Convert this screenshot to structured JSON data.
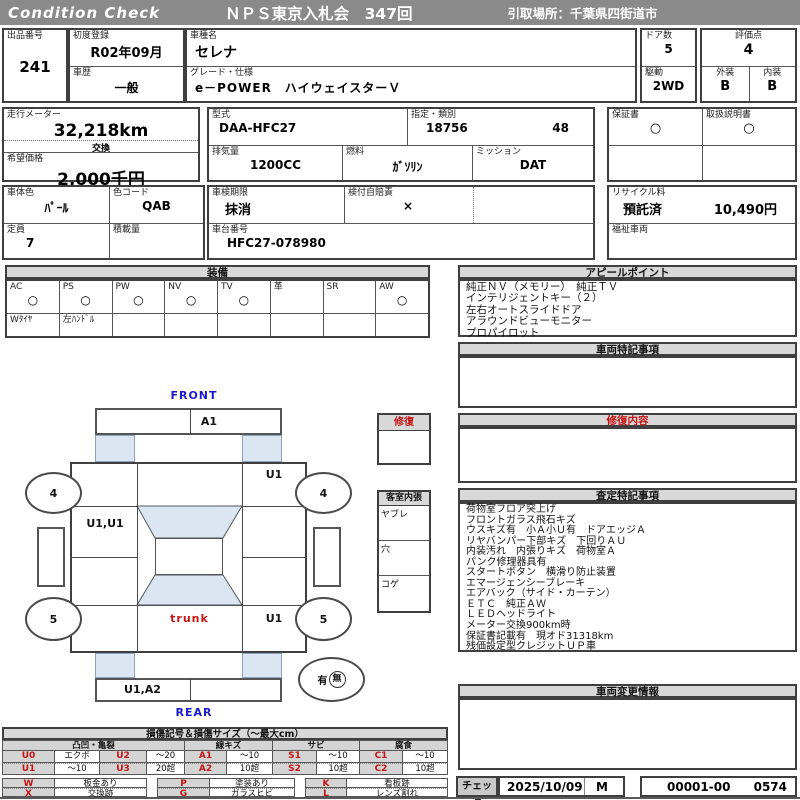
{
  "header": {
    "brand": "Condition  Check",
    "title": "ＮＰＳ東京入札会　347回",
    "pickup": "引取場所：千葉県四街道市"
  },
  "info": {
    "lot_label": "出品番号",
    "lot_value": "241",
    "first_reg_label": "初度登録",
    "first_reg_value": "R02年09月",
    "history_label": "車歴",
    "history_value": "一般",
    "model_name_label": "車種名",
    "model_name_value": "セレナ",
    "grade_label": "グレード・仕様",
    "grade_value": "e－POWER　ハイウェイスターＶ",
    "doors_label": "ドア数",
    "doors_value": "5",
    "score_label": "評価点",
    "score_value": "4",
    "drive_label": "駆動",
    "drive_value": "2WD",
    "exterior_label": "外装",
    "exterior_value": "B",
    "interior_label": "内装",
    "interior_value": "B",
    "odometer_label": "走行メーター",
    "odometer_value": "32,218km",
    "odometer_note": "交換",
    "price_label": "希望価格",
    "price_value": "2,000千円",
    "model_code_label": "型式",
    "model_code_value": "DAA-HFC27",
    "class_label": "指定・類別",
    "class_value1": "18756",
    "class_value2": "48",
    "displacement_label": "排気量",
    "displacement_value": "1200CC",
    "fuel_label": "燃料",
    "fuel_value": "ｶﾞｿﾘﾝ",
    "mission_label": "ミッション",
    "mission_value": "DAT",
    "warranty_label": "保証書",
    "warranty_value": "○",
    "manual_label": "取扱説明書",
    "manual_value": "○",
    "body_color_label": "車体色",
    "body_color_value": "ﾊﾟｰﾙ",
    "color_code_label": "色コード",
    "color_code_value": "QAB",
    "inspection_label": "車検期限",
    "inspection_value": "抹消",
    "insurance_label": "検付自賠責",
    "insurance_value": "×",
    "capacity_label": "定員",
    "capacity_value": "7",
    "load_label": "積載量",
    "load_value": "",
    "chassis_label": "車台番号",
    "chassis_value": "HFC27-078980",
    "recycle_label": "リサイクル料",
    "recycle_status": "預託済",
    "recycle_value": "10,490円",
    "welfare_label": "福祉車両",
    "welfare_value": ""
  },
  "equipment": {
    "title": "装備",
    "items": [
      {
        "label": "AC",
        "mark": "○"
      },
      {
        "label": "PS",
        "mark": "○"
      },
      {
        "label": "PW",
        "mark": "○"
      },
      {
        "label": "NV",
        "mark": "○"
      },
      {
        "label": "TV",
        "mark": "○"
      },
      {
        "label": "革",
        "mark": ""
      },
      {
        "label": "SR",
        "mark": ""
      },
      {
        "label": "AW",
        "mark": "○"
      }
    ],
    "extras": [
      "Wﾀｲﾔ",
      "左ﾊﾝﾄﾞﾙ",
      "",
      "",
      "",
      "",
      "",
      ""
    ]
  },
  "appeal": {
    "title": "アピールポイント",
    "lines": [
      "純正ＮＶ（メモリー）　純正ＴＶ",
      "インテリジェントキー（２）",
      "左右オートスライドドア",
      "アラウンドビューモニター",
      "プロパイロット"
    ]
  },
  "vehicle_notes": {
    "title": "車両特記事項"
  },
  "repair_detail": {
    "title": "修復内容"
  },
  "assessment": {
    "title": "査定特記事項",
    "lines": [
      "荷物室フロア突上げ",
      "フロントガラス飛石キズ",
      "ウスキズ有　小Ａ小Ｕ有　ドアエッジＡ",
      "リヤバンパー下部キズ　下回りＡＵ",
      "内装汚れ　内張りキズ　荷物室Ａ",
      "パンク修理器具有",
      "スタートボタン　横滑り防止装置",
      "エマージェンシーブレーキ",
      "エアバック（サイド・カーテン）",
      "ＥＴＣ　純正ＡＷ",
      "ＬＥＤヘッドライト",
      "メーター交換900km時",
      "保証書記載有　現オド31318km",
      "残価設定型クレジットＵＰ車"
    ]
  },
  "change_info": {
    "title": "車両変更情報"
  },
  "check": {
    "label": "チェック",
    "date": "2025/10/09",
    "inspector": "M",
    "number1": "00001-00",
    "number2": "0574"
  },
  "diagram": {
    "front_label": "FRONT",
    "rear_label": "REAR",
    "hood_mark": "A1",
    "front_right_mark": "U1",
    "left_door_mark": "U1,U1",
    "rear_right_mark": "U1",
    "trunk_label": "trunk",
    "bumper_mark": "U1,A2",
    "wheel_front_left": "4",
    "wheel_front_right": "4",
    "wheel_rear_left": "5",
    "wheel_rear_right": "5",
    "spare_has": "有",
    "spare_none": "無",
    "repair_box_title": "修復",
    "cabin_box_title": "客室内張",
    "cabin_rows": [
      "ヤブレ",
      "穴",
      "コゲ"
    ]
  },
  "legend": {
    "title": "損傷記号＆損傷サイズ（～最大cm）",
    "groups": [
      "凸凹・亀裂",
      "線キズ",
      "サビ",
      "腐食"
    ],
    "row1": [
      {
        "code": "U0",
        "val": "エクボ"
      },
      {
        "code": "U2",
        "val": "～20"
      },
      {
        "code": "A1",
        "val": "～10"
      },
      {
        "code": "S1",
        "val": "～10"
      },
      {
        "code": "C1",
        "val": "～10"
      }
    ],
    "row2": [
      {
        "code": "U1",
        "val": "～10"
      },
      {
        "code": "U3",
        "val": "20超"
      },
      {
        "code": "A2",
        "val": "10超"
      },
      {
        "code": "S2",
        "val": "10超"
      },
      {
        "code": "C2",
        "val": "10超"
      }
    ],
    "row3": [
      {
        "code": "W",
        "val": "板金あり"
      },
      {
        "code": "P",
        "val": "塗装あり"
      },
      {
        "code": "K",
        "val": "看板跡"
      }
    ],
    "row4": [
      {
        "code": "X",
        "val": "交換跡"
      },
      {
        "code": "G",
        "val": "ガラスヒビ"
      },
      {
        "code": "L",
        "val": "レンズ割れ"
      }
    ]
  },
  "colors": {
    "header_gray": "#8a8a8a",
    "section_gray": "#d8d8d8",
    "glass_blue": "#dce6f2",
    "mark_red": "#c41414",
    "direction_blue": "#1a1acc"
  }
}
